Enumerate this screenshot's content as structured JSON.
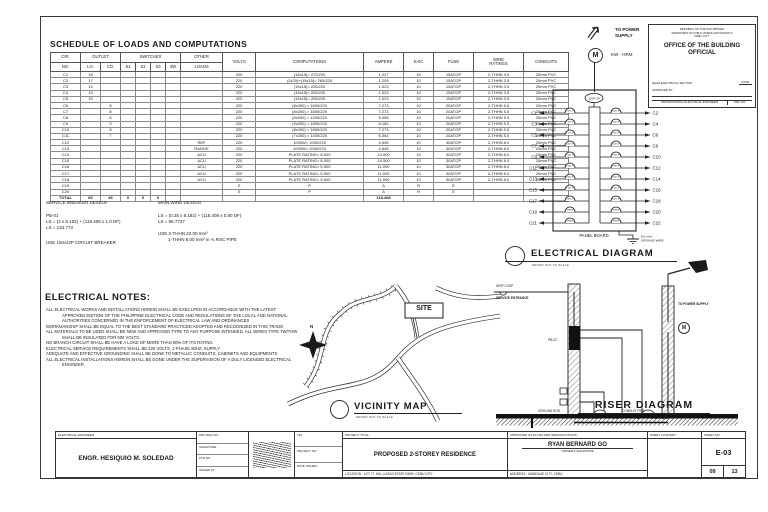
{
  "schedule": {
    "title": "SCHEDULE OF LOADS AND COMPUTATIONS",
    "headers": {
      "cir": "CIR.",
      "no": "NO.",
      "outlet": "OUTLET",
      "lo": "LO.",
      "co": "CO.",
      "switches": "SWITCHES",
      "s1": "S1",
      "s2": "S2",
      "s3": "S3",
      "w3": "3W",
      "other": "OTHER",
      "loads": "LOADS",
      "volts": "VOLTS",
      "computations": "COMPUTATIONS",
      "ampere": "AMPERE",
      "kaic": "KAIC",
      "fuse": "FUSE",
      "wire": "WIRE\nRATINGS",
      "conduits": "CONDUITS"
    },
    "rows": [
      [
        "C1",
        "18",
        "",
        "",
        "",
        "",
        "",
        "",
        "220",
        "(18x15)= 270/220",
        "1.227",
        "10",
        "15AT/2P",
        "2-THHN 3.5",
        "20mm PVC"
      ],
      [
        "C2",
        "17",
        "",
        "",
        "",
        "",
        "",
        "",
        "220",
        "(2x20)+(15x15)= 265/220",
        "1.205",
        "10",
        "15AT/2P",
        "2-THHN 3.5",
        "20mm PVC"
      ],
      [
        "C3",
        "15",
        "",
        "",
        "",
        "",
        "",
        "",
        "220",
        "(15x15)= 225/220",
        "1.023",
        "10",
        "15AT/2P",
        "2-THHN 3.5",
        "20mm PVC"
      ],
      [
        "C4",
        "15",
        "",
        "",
        "",
        "",
        "",
        "",
        "220",
        "(15x15)= 225/220",
        "1.023",
        "10",
        "15AT/2P",
        "2-THHN 3.5",
        "20mm PVC"
      ],
      [
        "C5",
        "15",
        "",
        "",
        "",
        "",
        "",
        "",
        "220",
        "(15x15)= 225/220",
        "1.023",
        "10",
        "15AT/2P",
        "2-THHN 3.5",
        "20mm PVC"
      ],
      [
        "C6",
        "",
        "8",
        "",
        "",
        "",
        "",
        "",
        "220",
        "(8x200) = 1600/220",
        "7.273",
        "10",
        "20AT/2P",
        "2-THHN 5.5",
        "20mm PVC"
      ],
      [
        "C7",
        "",
        "8",
        "",
        "",
        "",
        "",
        "",
        "220",
        "(8x200) = 1600/220",
        "7.273",
        "10",
        "20AT/2P",
        "2-THHN 5.5",
        "20mm PVC"
      ],
      [
        "C8",
        "",
        "6",
        "",
        "",
        "",
        "",
        "",
        "220",
        "(6x200) = 1200/220",
        "5.455",
        "10",
        "20AT/2P",
        "2-THHN 5.5",
        "20mm PVC"
      ],
      [
        "C9",
        "",
        "9",
        "",
        "",
        "",
        "",
        "",
        "220",
        "(9x200) = 1800/220",
        "8.182",
        "10",
        "20AT/2P",
        "2-THHN 5.5",
        "20mm PVC"
      ],
      [
        "C10",
        "",
        "8",
        "",
        "",
        "",
        "",
        "",
        "220",
        "(8x200) = 1600/220",
        "7.273",
        "10",
        "20AT/2P",
        "2-THHN 5.5",
        "20mm PVC"
      ],
      [
        "C11",
        "",
        "7",
        "",
        "",
        "",
        "",
        "",
        "220",
        "(7x200) = 1400/220",
        "6.364",
        "10",
        "20AT/2P",
        "2-THHN 5.5",
        "20mm PVC"
      ],
      [
        "C12",
        "",
        "",
        "",
        "",
        "",
        "",
        "REF",
        "220",
        "1000W= 1000/220",
        "4.545",
        "10",
        "30AT/2P",
        "2-THHN 8.0",
        "20mm PVC"
      ],
      [
        "C13",
        "",
        "",
        "",
        "",
        "",
        "",
        "RANGE",
        "220",
        "1000W= 1000/220",
        "4.545",
        "10",
        "30AT/2P",
        "2-THHN 8.0",
        "20mm PVC"
      ],
      [
        "C14",
        "",
        "",
        "",
        "",
        "",
        "",
        "ACU",
        "220",
        "PLATE RATING= 8.000",
        "14.500",
        "10",
        "30AT/2P",
        "2-THHN 8.0",
        "20mm PVC"
      ],
      [
        "C15",
        "",
        "",
        "",
        "",
        "",
        "",
        "ACU",
        "220",
        "PLATE RATING= 8.000",
        "14.500",
        "10",
        "30AT/2P",
        "2-THHN 8.0",
        "20mm PVC"
      ],
      [
        "C16",
        "",
        "",
        "",
        "",
        "",
        "",
        "ACU",
        "220",
        "PLATE RATING= 5.500",
        "11.000",
        "10",
        "30AT/2P",
        "2-THHN 8.0",
        "20mm PVC"
      ],
      [
        "C17",
        "",
        "",
        "",
        "",
        "",
        "",
        "ACU",
        "220",
        "PLATE RATING= 5.500",
        "11.000",
        "10",
        "30AT/2P",
        "2-THHN 8.0",
        "20mm PVC"
      ],
      [
        "C18",
        "",
        "",
        "",
        "",
        "",
        "",
        "ACU",
        "220",
        "PLATE RATING= 5.500",
        "11.000",
        "10",
        "30AT/2P",
        "2-THHN 8.0",
        "20mm PVC"
      ],
      [
        "C19",
        "",
        "",
        "",
        "",
        "",
        "",
        "",
        "S",
        "P",
        "A",
        "R",
        "E",
        "",
        ""
      ],
      [
        "C20",
        "",
        "",
        "",
        "",
        "",
        "",
        "",
        "S",
        "P",
        "A",
        "R",
        "E",
        "",
        ""
      ]
    ],
    "total": [
      "TOTAL",
      "80",
      "46",
      "0",
      "0",
      "0",
      "",
      "",
      "",
      "",
      "118.408",
      "",
      "",
      "",
      ""
    ]
  },
  "breaker_design": {
    "title": "SERVICE BREAKER DESIGN",
    "l1": "PB-01",
    "l2": "LS = (2 x 8.182) + (118.408 x 1.0 DF)",
    "l3": "LS = 134.773",
    "use": "USE 150A/2P CIRCUIT BREAKER"
  },
  "wire_design": {
    "title": "MAIN WIRE DESIGN",
    "l1": "LS = (0.25 x 8.182) + (118.408 x 0.80 DF)",
    "l2": "LS = 96.7727",
    "use1": "USE 2-THHN 22.00 mm²",
    "use2": "1-THHN 8.00 mm² in ¾ RSC PIPE"
  },
  "notes": {
    "title": "ELECTRICAL NOTES:",
    "items": [
      "ALL ELECTRICAL WORKS AND INSTALLATIONS HEREIN SHALL BE EXECUTED IN ACCORDANCE WITH THE LATEST APPROVED EDITION OF THE PHILIPPINE ELECTRICAL CODE AND REGULATIONS OF THE LOCAL AND NATIONAL AUTHORITIES CONCERNED IN THE ENFORCEMENT OF ELECTRICAL LAW AND ORDINANCES",
      "WORKMANSHIP SHALL BE EQUAL TO THE BEST STANDARD PRACTICED ADOPTED AND RECOGNIZED IN THIS TRADE",
      "ALL MATERIALS TO BE USED SHALL BE NEW AND APPROVED TYPE TO ANY PURPOSE INTENDED. ALL WIRES TYPE TW/THW SHALL BE INSULATED FOR 600 VOLTS.",
      "NO BRANCH CIRCUIT SHALL BE HAVE A LOAD OF MORE THAN 80% OF ITS RATING",
      "ELECTRICAL SERVICE REQUIREMENTS SHALL BE 220 VOLTS, 1-PHASE 60HZ, SUPPLY",
      "ADEQUATE AND EFFECTIVE GROUNDING SHALL BE DONE TO METALLIC CONDUITS, CABINETS AND EQUIPMENTS",
      "ALL ELECTRICAL INSTALLATIONS HEREIN SHALL BE DONE UNDER THE SUPERVISION OF A DULY LICENSED ELECTRICAL ENGINEER"
    ]
  },
  "official_box": {
    "line1": "REPUBLIC OF THE PHILIPPINES",
    "line2": "DEPARTMENT OF PUBLIC WORKS AND HIGHWAYS",
    "line3": "CEBU CITY",
    "title": "OFFICE OF THE BUILDING OFFICIAL",
    "left_sig": "HEAD ELECTRICAL SECTION",
    "date": "DATE",
    "approved": "APPROVED BY :",
    "bottom_left": "PROFESSIONAL ELECTRICAL ENGINEER",
    "bottom_right": "PRC NO."
  },
  "power": {
    "to_supply": "TO POWER SUPPLY",
    "meter": "M",
    "meter_label": "KW - HRM"
  },
  "panel": {
    "main_breaker": "150AT 2P",
    "label": "PANEL BOARD",
    "ground1": "8.0 mm²",
    "ground2": "GROUND WIRE",
    "left": [
      "C1",
      "C3",
      "C5",
      "C7",
      "C9",
      "C11",
      "C13",
      "C15",
      "C17",
      "C19",
      "C21"
    ],
    "right": [
      "C2",
      "C4",
      "C6",
      "C8",
      "C10",
      "C12",
      "C14",
      "C16",
      "C18",
      "C20",
      "C22"
    ],
    "left_ratings": [
      "15AT 2P",
      "15AT 2P",
      "15AT 2P",
      "20AT 2P",
      "20AT 2P",
      "20AT 2P",
      "30AT 2P",
      "30AT 2P",
      "30AT 2P",
      "SPARE",
      "SPARE"
    ],
    "right_ratings": [
      "15AT 2P",
      "15AT 2P",
      "20AT 2P",
      "20AT 2P",
      "20AT 2P",
      "30AT 2P",
      "30AT 2P",
      "30AT 2P",
      "30AT 2P",
      "SPARE",
      "SPARE"
    ]
  },
  "titles": {
    "electrical": {
      "main": "ELECTRICAL DIAGRAM",
      "sub": "DRAWN NOT TO SCALE"
    },
    "vicinity": {
      "main": "VICINITY MAP",
      "sub": "DRAWN NOT TO SCALE"
    },
    "riser": {
      "main": "RISER DIAGRAM",
      "sub": "DRAWN NOT TO SCALE"
    }
  },
  "vicinity": {
    "site": "SITE",
    "north": "N"
  },
  "riser": {
    "drip": "DRIP LOOP",
    "entrance": "SERVICE ENTRANCE",
    "supply": "TO POWER SUPPLY",
    "meter": "M",
    "panel": "PB-01",
    "ground_rod": "GROUND ROD",
    "conduit": "CONDUIT PIPE"
  },
  "titleblock": {
    "engineer_header": "ELECTRICAL ENGINEER",
    "engineer_name": "ENGR. HESIQUIO M. SOLEDAD",
    "fields_a": [
      "PRC REG NO. :",
      "SIGNATURE :",
      "PTR NO. :",
      "ISSUED AT :"
    ],
    "fields_b": [
      "TIN :",
      "PROJECT NO. :",
      "DATE ISSUED :"
    ],
    "project_header": "PROJECT TITLE :",
    "project_title": "PROPOSED 2-STOREY RESIDENCE",
    "project_location": "LOCATION : LOT 77, MA. LUISA ESTATE PARK, CEBU CITY",
    "approved_header": "APPROVED AS PLANS AND SPECIFICATIONS :",
    "owner_name": "RYAN BERNARD GO",
    "owner_sig": "OWNER'S SIGNATURE",
    "owner_address": "ADDRESS : MANDAUE CITY, CEBU",
    "content_header": "SHEET CONTENT",
    "sheetno_header": "SHEET NO.",
    "sheet_no": "E-03",
    "page": "09",
    "pages": "13"
  }
}
